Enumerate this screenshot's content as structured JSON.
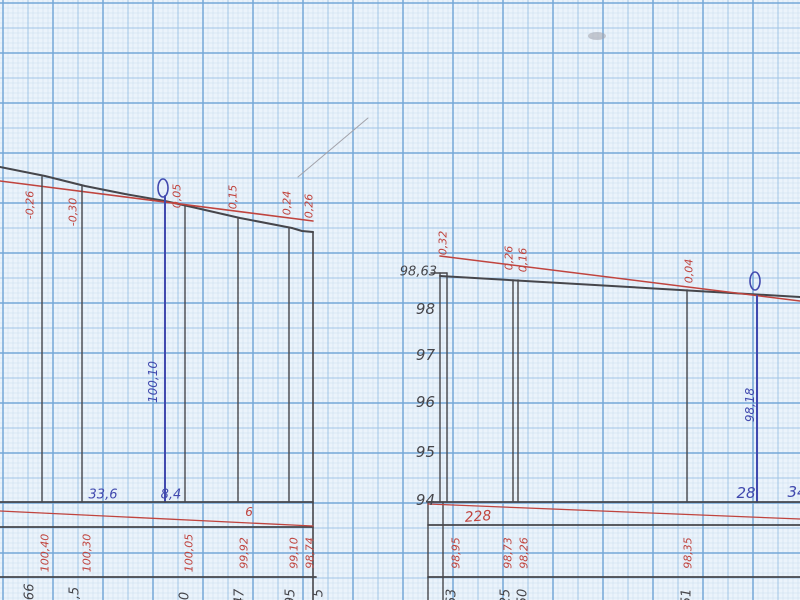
{
  "sheet": {
    "description": "Scanned millimeter graph paper with two hand-drawn leveling profile sections",
    "width": 800,
    "height": 600
  },
  "colors": {
    "paper": "#ebf3fb",
    "grid_fine": "#c9ddef",
    "grid_mid": "#a0c4e6",
    "grid_bold": "#74a8d8",
    "black": "#46464b",
    "red": "#c0443e",
    "blue": "#4149ae",
    "pencil": "#a3a3ab"
  },
  "labels": [
    {
      "name": "slope-mark",
      "text": "-0,26",
      "x": 30,
      "y": 205,
      "rot": -90,
      "color": "red",
      "size": 11
    },
    {
      "name": "slope-mark",
      "text": "-0,30",
      "x": 73,
      "y": 212,
      "rot": -90,
      "color": "red",
      "size": 11
    },
    {
      "name": "slope-mark",
      "text": "0,05",
      "x": 177,
      "y": 196,
      "rot": -90,
      "color": "red",
      "size": 11
    },
    {
      "name": "slope-mark",
      "text": "0,15",
      "x": 233,
      "y": 197,
      "rot": -90,
      "color": "red",
      "size": 11
    },
    {
      "name": "slope-mark",
      "text": "0,24",
      "x": 287,
      "y": 203,
      "rot": -90,
      "color": "red",
      "size": 11
    },
    {
      "name": "slope-mark",
      "text": "0,26",
      "x": 309,
      "y": 206,
      "rot": -90,
      "color": "red",
      "size": 11
    },
    {
      "name": "datum-elevation",
      "text": "100,10",
      "x": 153,
      "y": 382,
      "rot": -90,
      "color": "blue",
      "size": 12
    },
    {
      "name": "distance-value",
      "text": "33,6",
      "x": 103,
      "y": 495,
      "rot": 0,
      "color": "blue",
      "size": 13
    },
    {
      "name": "distance-value",
      "text": "8,4",
      "x": 171,
      "y": 495,
      "rot": 0,
      "color": "blue",
      "size": 13
    },
    {
      "name": "red-note",
      "text": "6",
      "x": 249,
      "y": 512,
      "rot": 0,
      "color": "red",
      "size": 12
    },
    {
      "name": "design-elevation",
      "text": "100,40",
      "x": 45,
      "y": 553,
      "rot": -90,
      "color": "red",
      "size": 11
    },
    {
      "name": "design-elevation",
      "text": "100,30",
      "x": 87,
      "y": 553,
      "rot": -90,
      "color": "red",
      "size": 11
    },
    {
      "name": "design-elevation",
      "text": "100,05",
      "x": 189,
      "y": 553,
      "rot": -90,
      "color": "red",
      "size": 11
    },
    {
      "name": "design-elevation",
      "text": "99,92",
      "x": 244,
      "y": 553,
      "rot": -90,
      "color": "red",
      "size": 11
    },
    {
      "name": "design-elevation",
      "text": "99,10",
      "x": 294,
      "y": 553,
      "rot": -90,
      "color": "red",
      "size": 11
    },
    {
      "name": "design-elevation",
      "text": "98,74",
      "x": 310,
      "y": 553,
      "rot": -90,
      "color": "red",
      "size": 11
    },
    {
      "name": "ground-elevation-fragment",
      "text": "9,66",
      "x": 30,
      "y": 598,
      "rot": -90,
      "color": "black",
      "size": 13
    },
    {
      "name": "ground-elevation-fragment",
      "text": "3,5",
      "x": 75,
      "y": 597,
      "rot": -90,
      "color": "black",
      "size": 13
    },
    {
      "name": "ground-elevation-fragment",
      "text": "0",
      "x": 185,
      "y": 596,
      "rot": -90,
      "color": "black",
      "size": 13
    },
    {
      "name": "ground-elevation-fragment",
      "text": "47",
      "x": 240,
      "y": 597,
      "rot": -90,
      "color": "black",
      "size": 13
    },
    {
      "name": "ground-elevation-fragment",
      "text": "95",
      "x": 291,
      "y": 597,
      "rot": -90,
      "color": "black",
      "size": 13
    },
    {
      "name": "ground-elevation-fragment",
      "text": "5",
      "x": 319,
      "y": 593,
      "rot": -90,
      "color": "black",
      "size": 13
    },
    {
      "name": "axis-elevation",
      "text": "98,63",
      "x": 437,
      "y": 272,
      "rot": 0,
      "color": "black",
      "size": 13,
      "anchor": "end"
    },
    {
      "name": "axis-elevation",
      "text": "98",
      "x": 435,
      "y": 309,
      "rot": 0,
      "color": "black",
      "size": 15,
      "anchor": "end"
    },
    {
      "name": "axis-elevation",
      "text": "97",
      "x": 435,
      "y": 355,
      "rot": 0,
      "color": "black",
      "size": 15,
      "anchor": "end"
    },
    {
      "name": "axis-elevation",
      "text": "96",
      "x": 435,
      "y": 402,
      "rot": 0,
      "color": "black",
      "size": 15,
      "anchor": "end"
    },
    {
      "name": "axis-elevation",
      "text": "95",
      "x": 435,
      "y": 452,
      "rot": 0,
      "color": "black",
      "size": 15,
      "anchor": "end"
    },
    {
      "name": "axis-elevation",
      "text": "94",
      "x": 435,
      "y": 500,
      "rot": 0,
      "color": "black",
      "size": 15,
      "anchor": "end"
    },
    {
      "name": "slope-mark",
      "text": "0,32",
      "x": 443,
      "y": 243,
      "rot": -90,
      "color": "red",
      "size": 11
    },
    {
      "name": "slope-mark",
      "text": "0,26",
      "x": 509,
      "y": 258,
      "rot": -90,
      "color": "red",
      "size": 11
    },
    {
      "name": "slope-mark",
      "text": "0,16",
      "x": 523,
      "y": 260,
      "rot": -90,
      "color": "red",
      "size": 11
    },
    {
      "name": "slope-mark",
      "text": "0,04",
      "x": 689,
      "y": 271,
      "rot": -90,
      "color": "red",
      "size": 11
    },
    {
      "name": "datum-elevation",
      "text": "98,18",
      "x": 750,
      "y": 405,
      "rot": -90,
      "color": "blue",
      "size": 12
    },
    {
      "name": "distance-value",
      "text": "28",
      "x": 746,
      "y": 493,
      "rot": 0,
      "color": "blue",
      "size": 15
    },
    {
      "name": "distance-value",
      "text": "34",
      "x": 797,
      "y": 492,
      "rot": 0,
      "color": "blue",
      "size": 15
    },
    {
      "name": "red-note",
      "text": "228",
      "x": 478,
      "y": 517,
      "rot": -4,
      "color": "red",
      "size": 14
    },
    {
      "name": "design-elevation",
      "text": "98,95",
      "x": 456,
      "y": 553,
      "rot": -90,
      "color": "red",
      "size": 11
    },
    {
      "name": "design-elevation",
      "text": "98,73",
      "x": 508,
      "y": 553,
      "rot": -90,
      "color": "red",
      "size": 11
    },
    {
      "name": "design-elevation",
      "text": "98,26",
      "x": 524,
      "y": 553,
      "rot": -90,
      "color": "red",
      "size": 11
    },
    {
      "name": "design-elevation",
      "text": "98,35",
      "x": 688,
      "y": 553,
      "rot": -90,
      "color": "red",
      "size": 11
    },
    {
      "name": "ground-elevation-fragment",
      "text": "63",
      "x": 452,
      "y": 597,
      "rot": -90,
      "color": "black",
      "size": 13
    },
    {
      "name": "ground-elevation-fragment",
      "text": "25",
      "x": 506,
      "y": 597,
      "rot": -90,
      "color": "black",
      "size": 13
    },
    {
      "name": "ground-elevation-fragment",
      "text": "50",
      "x": 523,
      "y": 597,
      "rot": -90,
      "color": "black",
      "size": 13
    },
    {
      "name": "ground-elevation-fragment",
      "text": "51",
      "x": 687,
      "y": 597,
      "rot": -90,
      "color": "black",
      "size": 13
    }
  ],
  "ellipses": [
    {
      "name": "zero-point-mark",
      "cx": 163,
      "cy": 188,
      "rx": 5,
      "ry": 9,
      "color": "blue"
    },
    {
      "name": "zero-point-mark",
      "cx": 755,
      "cy": 281,
      "rx": 5,
      "ry": 9,
      "color": "blue"
    },
    {
      "name": "scan-smudge",
      "cx": 597,
      "cy": 36,
      "rx": 9,
      "ry": 4,
      "color": "pencil",
      "fill": true
    }
  ],
  "lines": [
    {
      "name": "ground-profile-line",
      "points": [
        [
          0,
          167
        ],
        [
          45,
          176
        ],
        [
          85,
          186
        ],
        [
          125,
          194
        ],
        [
          165,
          201
        ],
        [
          192,
          207
        ],
        [
          240,
          218
        ],
        [
          292,
          228
        ],
        [
          302,
          231
        ],
        [
          313,
          232
        ]
      ],
      "color": "black",
      "width": 2
    },
    {
      "name": "design-grade-line",
      "points": [
        [
          0,
          181
        ],
        [
          313,
          221
        ]
      ],
      "color": "red",
      "width": 1.6
    },
    {
      "name": "profile-ordinate",
      "points": [
        [
          42,
          177
        ],
        [
          42,
          502
        ]
      ],
      "color": "black",
      "width": 1.4
    },
    {
      "name": "profile-ordinate",
      "points": [
        [
          82,
          186
        ],
        [
          82,
          502
        ]
      ],
      "color": "black",
      "width": 1.4
    },
    {
      "name": "profile-ordinate",
      "points": [
        [
          185,
          206
        ],
        [
          185,
          502
        ]
      ],
      "color": "black",
      "width": 1.4
    },
    {
      "name": "profile-ordinate",
      "points": [
        [
          238,
          218
        ],
        [
          238,
          502
        ]
      ],
      "color": "black",
      "width": 1.4
    },
    {
      "name": "profile-ordinate",
      "points": [
        [
          289,
          228
        ],
        [
          289,
          502
        ]
      ],
      "color": "black",
      "width": 1.4
    },
    {
      "name": "panel-boundary",
      "points": [
        [
          313,
          232
        ],
        [
          313,
          600
        ]
      ],
      "color": "black",
      "width": 1.6
    },
    {
      "name": "datum-ordinate",
      "points": [
        [
          165,
          196
        ],
        [
          165,
          502
        ]
      ],
      "color": "blue",
      "width": 2
    },
    {
      "name": "table-rule",
      "points": [
        [
          0,
          502
        ],
        [
          313,
          502
        ]
      ],
      "color": "black",
      "width": 1.8
    },
    {
      "name": "table-rule",
      "points": [
        [
          0,
          527
        ],
        [
          313,
          527
        ]
      ],
      "color": "black",
      "width": 1.8
    },
    {
      "name": "table-rule",
      "points": [
        [
          0,
          577
        ],
        [
          316,
          577
        ]
      ],
      "color": "black",
      "width": 1.8
    },
    {
      "name": "red-grade-row-line",
      "points": [
        [
          0,
          511
        ],
        [
          313,
          526
        ]
      ],
      "color": "red",
      "width": 1.3
    },
    {
      "name": "elevation-axis",
      "points": [
        [
          440,
          273
        ],
        [
          440,
          502
        ]
      ],
      "color": "black",
      "width": 1.4
    },
    {
      "name": "profile-ordinate",
      "points": [
        [
          447,
          273
        ],
        [
          447,
          502
        ]
      ],
      "color": "black",
      "width": 1.4
    },
    {
      "name": "axis-top-tick",
      "points": [
        [
          431,
          273
        ],
        [
          447,
          273
        ]
      ],
      "color": "black",
      "width": 1.4
    },
    {
      "name": "ground-profile-line",
      "points": [
        [
          440,
          276
        ],
        [
          800,
          297
        ]
      ],
      "color": "black",
      "width": 2
    },
    {
      "name": "design-grade-line",
      "points": [
        [
          440,
          256
        ],
        [
          800,
          301
        ]
      ],
      "color": "red",
      "width": 1.6
    },
    {
      "name": "profile-ordinate",
      "points": [
        [
          513,
          280
        ],
        [
          513,
          502
        ]
      ],
      "color": "black",
      "width": 1.4
    },
    {
      "name": "profile-ordinate",
      "points": [
        [
          518,
          280
        ],
        [
          518,
          502
        ]
      ],
      "color": "black",
      "width": 1.4
    },
    {
      "name": "profile-ordinate",
      "points": [
        [
          687,
          290
        ],
        [
          687,
          502
        ]
      ],
      "color": "black",
      "width": 1.4
    },
    {
      "name": "datum-ordinate",
      "points": [
        [
          757,
          296
        ],
        [
          757,
          502
        ]
      ],
      "color": "blue",
      "width": 2
    },
    {
      "name": "table-rule",
      "points": [
        [
          428,
          502
        ],
        [
          800,
          502
        ]
      ],
      "color": "black",
      "width": 1.8
    },
    {
      "name": "table-rule",
      "points": [
        [
          428,
          525
        ],
        [
          800,
          525
        ]
      ],
      "color": "black",
      "width": 1.8
    },
    {
      "name": "table-rule",
      "points": [
        [
          428,
          577
        ],
        [
          800,
          577
        ]
      ],
      "color": "black",
      "width": 1.8
    },
    {
      "name": "table-edge",
      "points": [
        [
          428,
          502
        ],
        [
          428,
          600
        ]
      ],
      "color": "black",
      "width": 1.4
    },
    {
      "name": "table-edge",
      "points": [
        [
          443,
          502
        ],
        [
          443,
          600
        ]
      ],
      "color": "black",
      "width": 1.4
    },
    {
      "name": "red-grade-row-line",
      "points": [
        [
          428,
          504
        ],
        [
          800,
          519
        ]
      ],
      "color": "red",
      "width": 1.3
    },
    {
      "name": "pencil-scratch",
      "points": [
        [
          298,
          177
        ],
        [
          368,
          118
        ]
      ],
      "color": "pencil",
      "width": 1
    }
  ]
}
